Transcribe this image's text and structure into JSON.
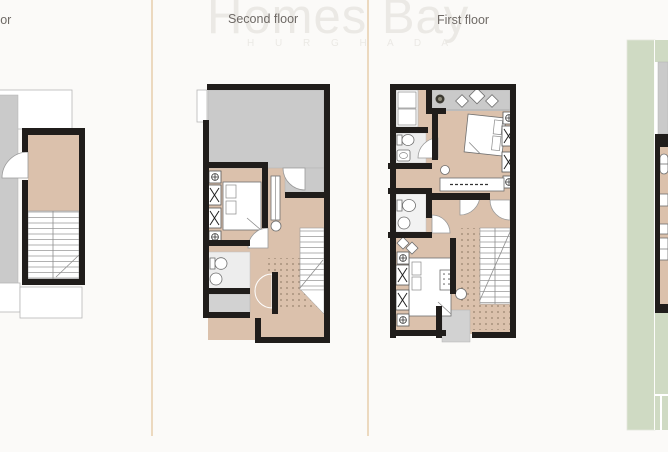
{
  "watermark": {
    "brand": "Homes Bay",
    "sub_brand": "H U R G H A D A"
  },
  "panels": {
    "left": {
      "label": "floor"
    },
    "second": {
      "label": "Second floor"
    },
    "first": {
      "label": "First floor"
    }
  },
  "colors": {
    "background": "#fbfaf8",
    "divider": "#ecd9bf",
    "wall": "#201d1b",
    "floor": "#dbc1ac",
    "terrace": "#cacaca",
    "bath": "#ededed",
    "garden": "#cfdac3",
    "label_text": "#6f6a66",
    "watermark": "#ebe9e5"
  }
}
